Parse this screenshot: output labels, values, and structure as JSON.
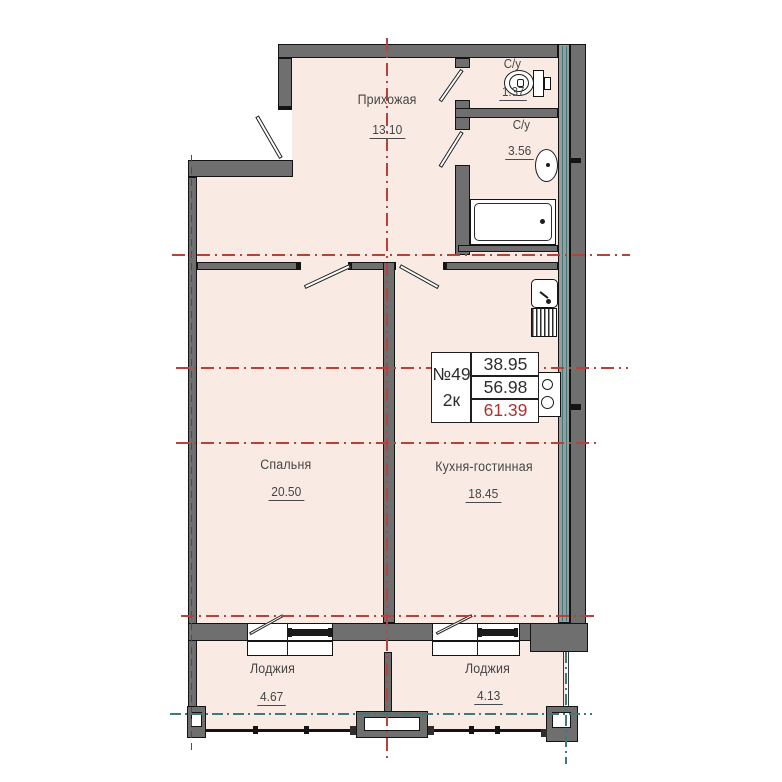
{
  "plan": {
    "title": "apartment-floor-plan",
    "unit_info": {
      "number": "№49",
      "rooms_type": "2к",
      "area_living": "38.95",
      "area_total": "56.98",
      "area_full": "61.39"
    },
    "rooms": {
      "hallway": {
        "name": "Прихожая",
        "area": "13.10"
      },
      "wc_small": {
        "name": "С/у",
        "area": "1.37"
      },
      "wc_big": {
        "name": "С/у",
        "area": "3.56"
      },
      "bedroom": {
        "name": "Спальня",
        "area": "20.50"
      },
      "kitchen_living": {
        "name": "Кухня-гостинная",
        "area": "18.45"
      },
      "loggia_left": {
        "name": "Лоджия",
        "area": "4.67"
      },
      "loggia_right": {
        "name": "Лоджия",
        "area": "4.13"
      }
    },
    "colors": {
      "floor": "#f9ebe3",
      "wall": "#6f6f6f",
      "outline": "#141414",
      "axis_red": "#b5433c",
      "axis_teal": "#3e7a7a",
      "highlight_red": "#b03030"
    },
    "fixtures": [
      "toilet",
      "wall-sink",
      "bathtub",
      "kitchen-sink",
      "vent-shaft",
      "stove",
      "window",
      "door"
    ]
  }
}
